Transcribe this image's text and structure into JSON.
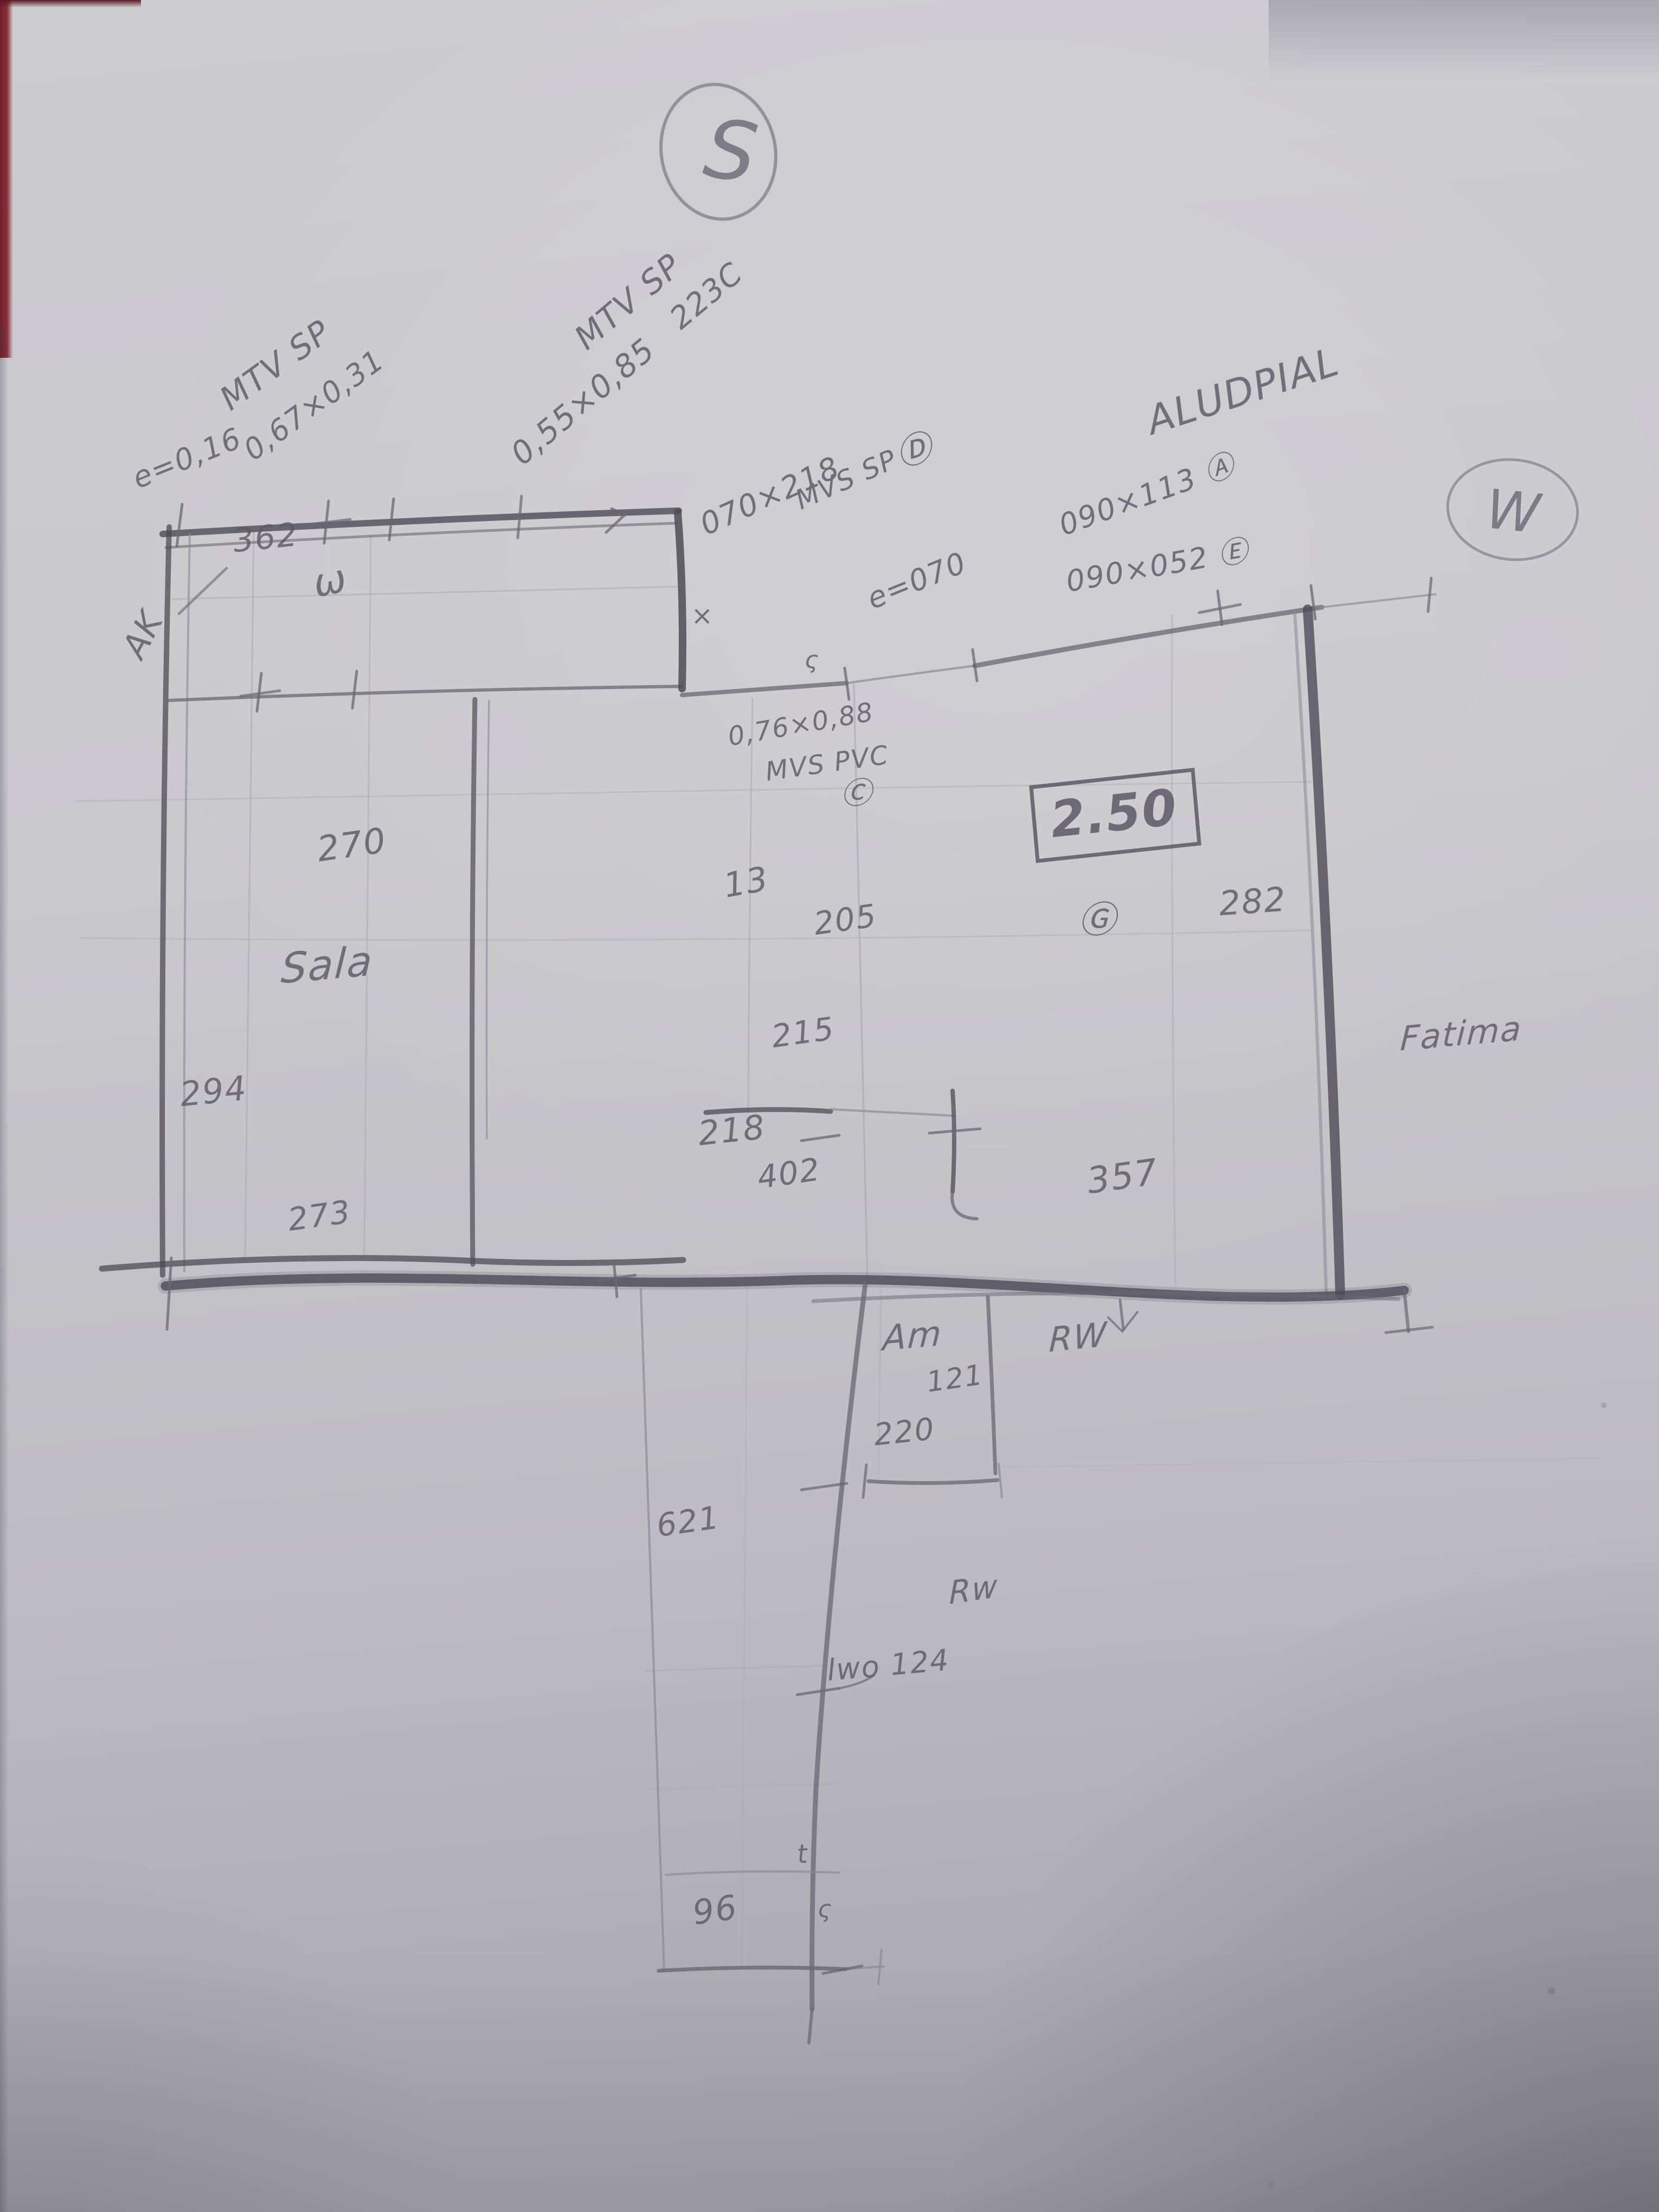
{
  "photo": {
    "compass": {
      "south_label": "S",
      "west_label": "W"
    },
    "rooms": {
      "living": "Sala",
      "am": "Am",
      "neighbor": "Fatima",
      "rw_upper": "RW",
      "rw_lower": "Rw",
      "ak": "AK"
    },
    "openings": {
      "left_window_type": "MTV SP",
      "left_window_thickness": "e=0,16",
      "left_window_size": "0,67×0,31",
      "top_window_type": "MTV SP",
      "top_window_size": "0,55×0,85",
      "top_window_code": "223C",
      "door_size": "070×218",
      "door_type": "MVS SP",
      "door_tag": "Ⓓ",
      "wall_note": "e=070",
      "alu_type": "ALUDPIAL",
      "window_a": "090×113 Ⓐ",
      "window_e": "090×052 Ⓔ",
      "pvc_window_size": "0,76×0,88",
      "pvc_window_type": "MVS PVC",
      "pvc_window_tag": "Ⓒ",
      "tag_g": "Ⓖ",
      "ceiling_height": "2.50"
    },
    "dimensions": {
      "top_width": "362",
      "sala_width": "270",
      "sala_height": "294",
      "sala_bottom": "273",
      "mid_top": "13",
      "mid_width": "205",
      "mid_height": "215",
      "mid_bottom": "218",
      "gap_width": "402",
      "right_bottom": "357",
      "right_width": "282",
      "am_height": "121",
      "am_width": "220",
      "hall_height": "621",
      "hall_width": "96",
      "note_124": "lwo 124"
    },
    "marks": {
      "omega": "ω",
      "x_tick": "×",
      "s_tick": "ς",
      "t_tick": "t",
      "s_tick_2": "ς"
    }
  }
}
